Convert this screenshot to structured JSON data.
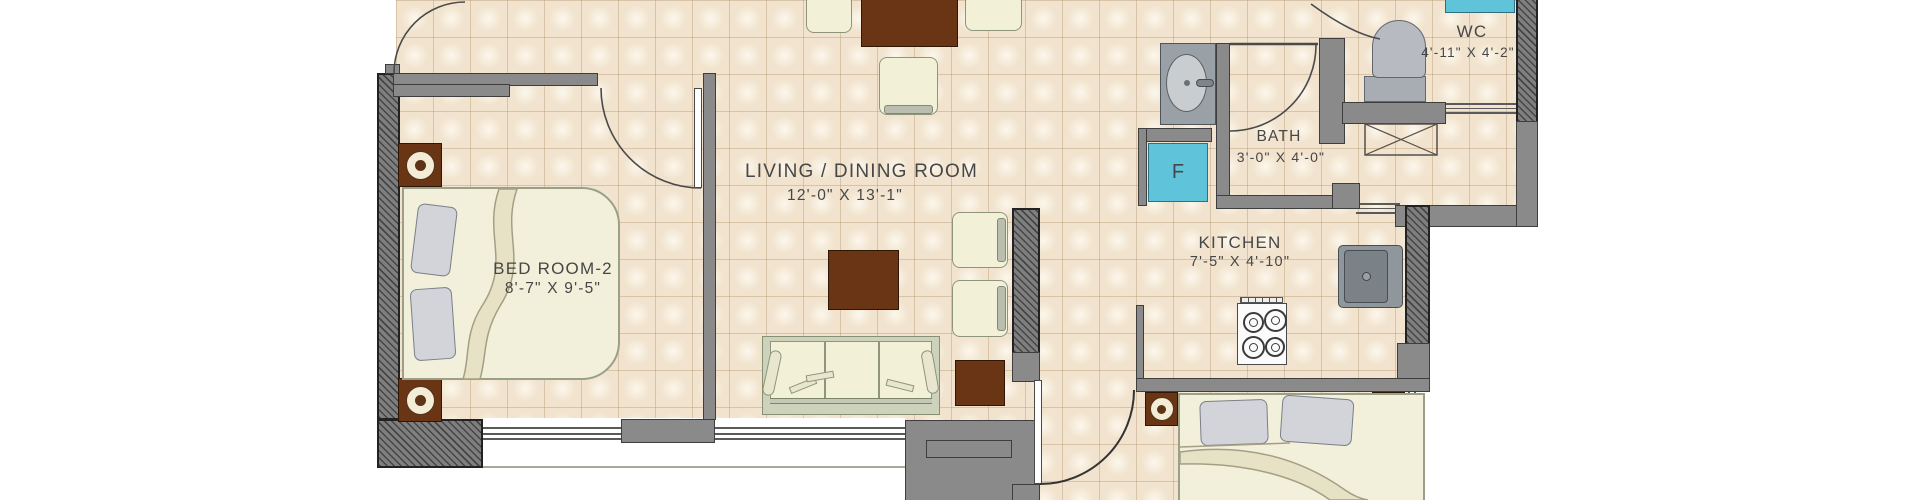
{
  "title": "apartment floor plan",
  "rooms": {
    "bedroom2": {
      "name": "BED ROOM-2",
      "dims": "8'-7\" X 9'-5\""
    },
    "living": {
      "name": "LIVING / DINING ROOM",
      "dims": "12'-0\" X 13'-1\""
    },
    "kitchen": {
      "name": "KITCHEN",
      "dims": "7'-5\" X 4'-10\""
    },
    "bath": {
      "name": "BATH",
      "dims": "3'-0\" X 4'-0\""
    },
    "wc": {
      "name": "WC",
      "dims": "4'-11\" X 4'-2\""
    }
  },
  "labels": {
    "fridge": "F"
  },
  "palette": {
    "floor_tile": "#f1e3cd",
    "tile_grid": "#cdb18c",
    "wall_gray": "#8a8a8a",
    "wall_outline": "#3e3e3e",
    "furniture_brown": "#693514",
    "furniture_cream": "#f3f0d8",
    "pillow_gray": "#d3d4d9",
    "sofa_frame": "#ccd2bc",
    "appliance_cyan": "#5fc4da",
    "fixture_gray": "#9aa1a6",
    "text_gray": "#474747",
    "background": "#ffffff"
  }
}
